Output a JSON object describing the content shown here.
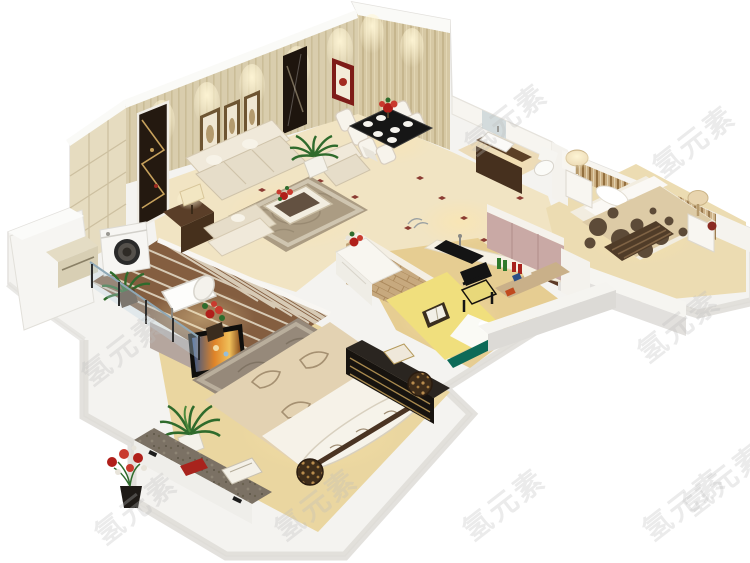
{
  "meta": {
    "type": "3d-isometric-apartment-floorplan-render",
    "canvas_width": 750,
    "canvas_height": 563,
    "background": "#ffffff"
  },
  "watermark": {
    "text": "氢元素",
    "font_size_px": 29,
    "rotation_deg": -38,
    "color": "rgba(190,190,190,0.30)",
    "positions": [
      {
        "x": 505,
        "y": 118
      },
      {
        "x": 693,
        "y": 140
      },
      {
        "x": 122,
        "y": 348
      },
      {
        "x": 678,
        "y": 325
      },
      {
        "x": 723,
        "y": 478
      },
      {
        "x": 135,
        "y": 507
      },
      {
        "x": 315,
        "y": 503
      },
      {
        "x": 503,
        "y": 503
      },
      {
        "x": 683,
        "y": 503
      }
    ]
  },
  "palette": {
    "wall_beige": "#d9cdad",
    "wall_stripe": "#cbbd98",
    "molding_white": "#fafaf7",
    "floor_cream": "#f1e4c3",
    "floor_wood": "#e9d5a2",
    "tile_brown": "#8a6142",
    "grout": "#f3ead8",
    "rug_living": "#ab9c83",
    "rug_master": "#96897a",
    "sofa_beige": "#eae2d1",
    "accent_red": "#8e201c",
    "plant_green": "#2f6b2c",
    "bed_yellow": "#f0df7d",
    "teal": "#0d6a58",
    "cabinet_pink": "#c9a9a5",
    "wood_dark": "#4a3220",
    "granite": "#7b7164",
    "slab_white": "#f4f3f0",
    "slab_shadow": "#dedcd7",
    "glow": "#ffe6a8",
    "polka_dot": "#5d4b38",
    "tv_screen_orange": "#e08428"
  },
  "scene": {
    "rooms": [
      {
        "id": "living-room",
        "label": "living room",
        "furniture": [
          "striped wallpaper wall",
          "three framed pictures",
          "wall mirror",
          "red framed picture",
          "fabric sofa set",
          "patterned rug",
          "coffee table with red flowers",
          "dark sideboard with table lamp",
          "display niche",
          "potted palm"
        ]
      },
      {
        "id": "dining-area",
        "label": "dining area",
        "furniture": [
          "black glass dining table",
          "white upholstered chairs",
          "red flower centerpiece",
          "striped feature wall"
        ]
      },
      {
        "id": "kitchen",
        "label": "kitchen",
        "furniture": [
          "counter with black sink",
          "mauve tall cabinets",
          "bottles and fruit bowl",
          "white sideboard with flowers",
          "brick half wall"
        ]
      },
      {
        "id": "bathroom",
        "label": "bathroom",
        "furniture": [
          "dark wood vanity",
          "white basin",
          "mirror",
          "toilet"
        ]
      },
      {
        "id": "bedroom-right",
        "label": "second bedroom",
        "furniture": [
          "double bed with polka-dot duvet",
          "striped headboard and curtains",
          "two nightstands",
          "mushroom table lamps",
          "dark dresser"
        ]
      },
      {
        "id": "study-room",
        "label": "study / tatami room",
        "furniture": [
          "yellow tatami bed",
          "black armchair with yellow cushion",
          "desk with books",
          "open book"
        ]
      },
      {
        "id": "master-bedroom",
        "label": "master bedroom",
        "furniture": [
          "floral double bed",
          "bolster pillow",
          "leopard round cushions",
          "grey floral rug",
          "wall TV",
          "black gold-trimmed dresser",
          "leopard stool",
          "potted palm",
          "granite console with books",
          "flower bouquet"
        ]
      },
      {
        "id": "laundry-balcony",
        "label": "laundry balcony",
        "furniture": [
          "washing machine",
          "glazed tile floor",
          "glass railing",
          "white lounge chair",
          "potted plants",
          "built-in cabinet"
        ]
      }
    ]
  }
}
